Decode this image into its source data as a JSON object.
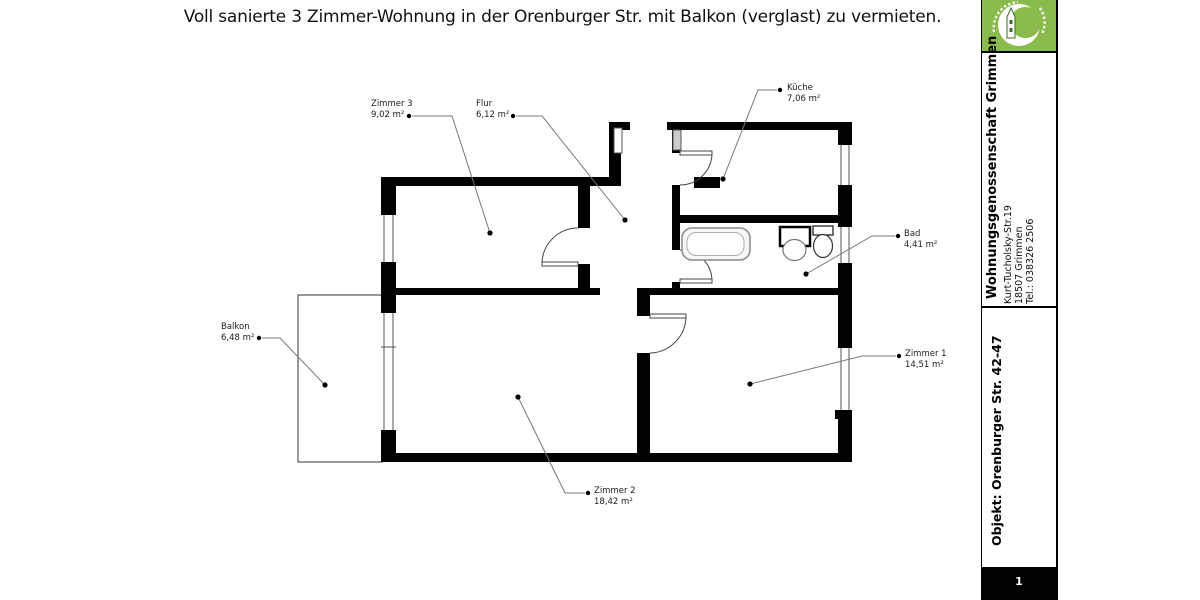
{
  "title": "Voll sanierte 3 Zimmer-Wohnung in der Orenburger Str. mit Balkon (verglast) zu vermieten.",
  "rooms": {
    "zimmer3": {
      "name": "Zimmer 3",
      "area": "9,02 m²"
    },
    "flur": {
      "name": "Flur",
      "area": "6,12 m²"
    },
    "kueche": {
      "name": "Küche",
      "area": "7,06 m²"
    },
    "bad": {
      "name": "Bad",
      "area": "4,41 m²"
    },
    "zimmer1": {
      "name": "Zimmer 1",
      "area": "14,51 m²"
    },
    "zimmer2": {
      "name": "Zimmer 2",
      "area": "18,42 m²"
    },
    "balkon": {
      "name": "Balkon",
      "area": "6,48 m²"
    }
  },
  "sidebar": {
    "company": "Wohnungsgenossenschaft Grimmen",
    "address_line1": "Kurt-Tucholsky-Str.19",
    "address_line2": "18507 Grimmen",
    "phone": "Tel.: 038326 2506",
    "object": "Objekt: Orenburger Str. 42-47",
    "page_number": "1",
    "brand_green": "#8cbb4d"
  }
}
